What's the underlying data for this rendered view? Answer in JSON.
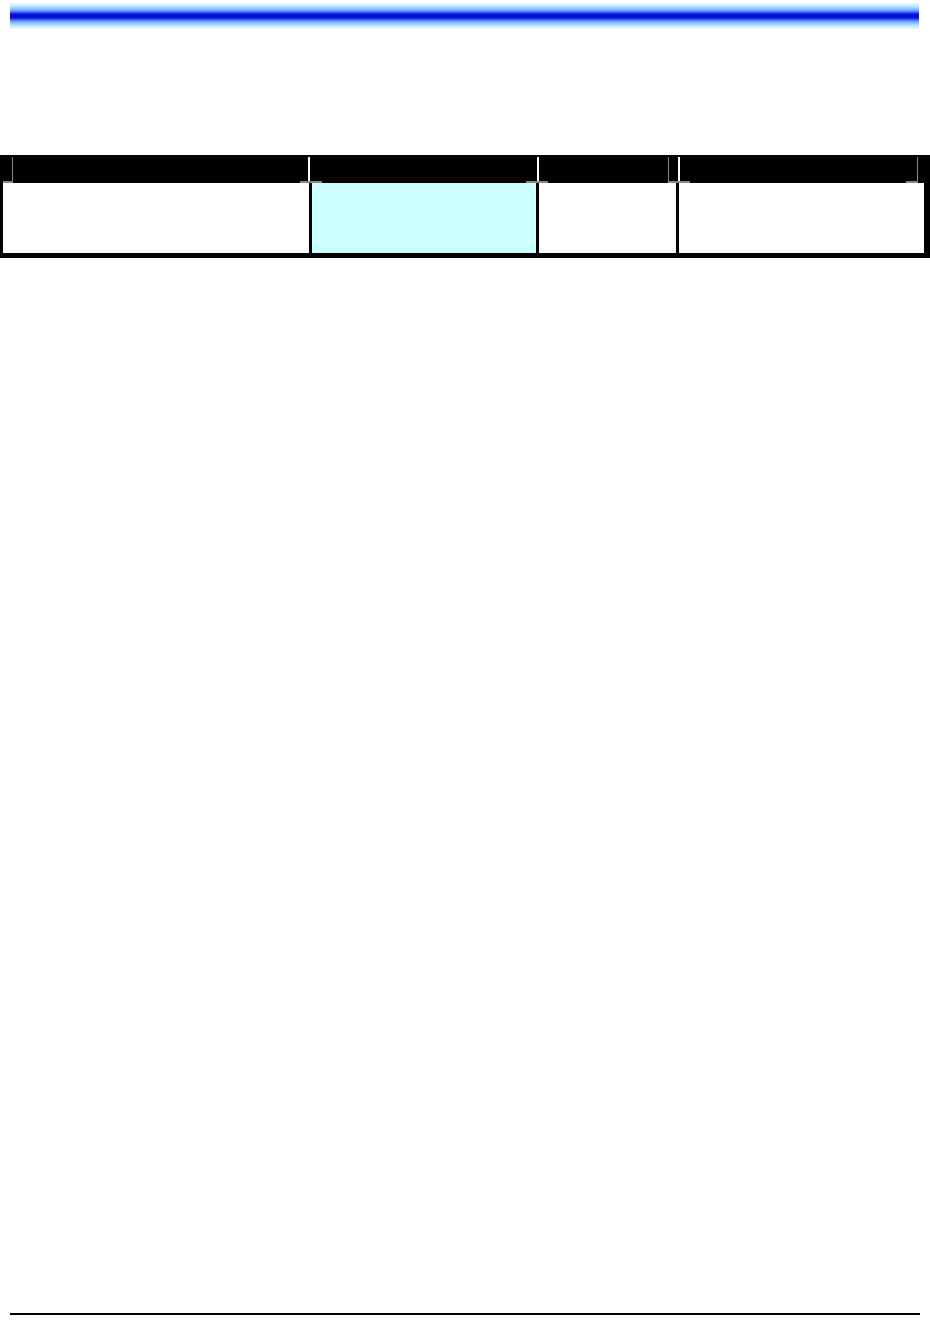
{
  "page": {
    "background_color": "#ffffff",
    "top_bar": {
      "edge_color": "#cceeff",
      "mid_color": "#77aaff",
      "center_color": "#0011dd"
    },
    "footer_rule_color": "#000000"
  },
  "table": {
    "header_background": "#000000",
    "header_tick_white": "#ffffff",
    "header_tick_gray": "#888888",
    "border_color": "#000000",
    "highlight_color": "#ccffff",
    "columns": [
      {
        "header_label": "",
        "cell_value": "",
        "cell_background": "#ffffff"
      },
      {
        "header_label": "",
        "cell_value": "",
        "cell_background": "#ccffff"
      },
      {
        "header_label": "",
        "cell_value": "",
        "cell_background": "#ffffff"
      },
      {
        "header_label": "",
        "cell_value": "",
        "cell_background": "#ffffff"
      }
    ]
  }
}
